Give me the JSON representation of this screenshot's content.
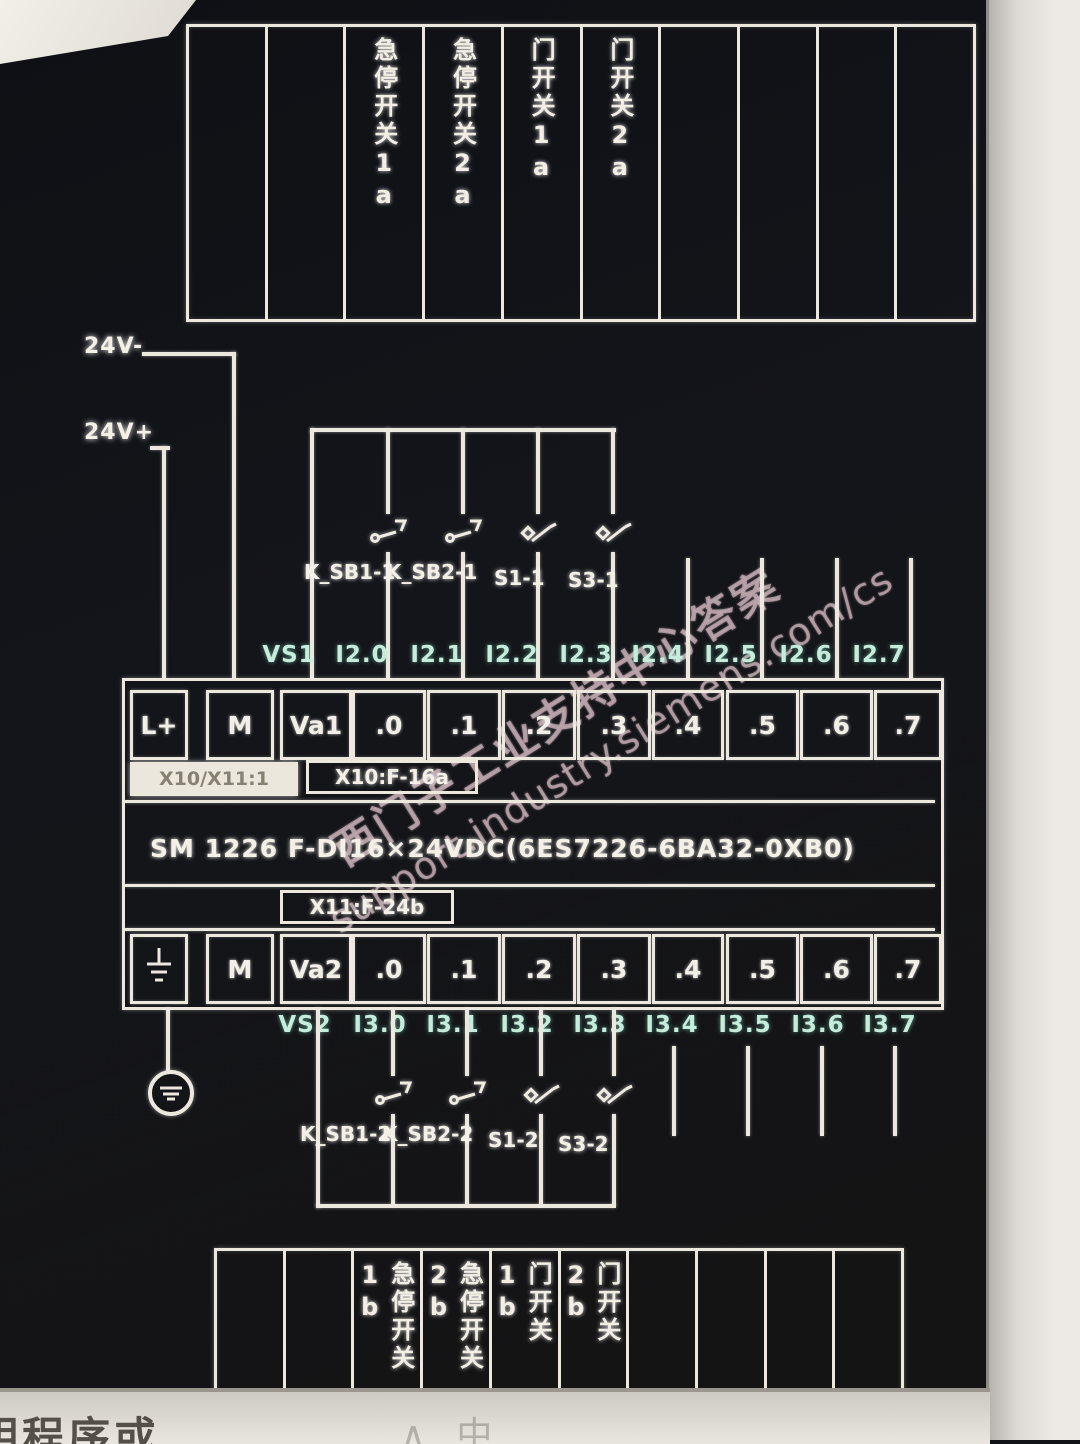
{
  "watermark": {
    "line1": "西门子工业支持中心答案",
    "line2": "support.industry.siemens.com/cs"
  },
  "screen": {
    "bottom_text": "明程序或",
    "bottom_marks": "∧中"
  },
  "power": {
    "neg_label": "24V-",
    "pos_label": "24V+"
  },
  "top_strip": {
    "columns": [
      "",
      "",
      "急停开关1a",
      "急停开关2a",
      "门开关1a",
      "门开关2a",
      "",
      "",
      "",
      ""
    ]
  },
  "bottom_strip": {
    "columns": [
      "",
      "",
      "急停开关1b",
      "急停开关2b",
      "门开关1b",
      "门开关2b",
      "",
      "",
      "",
      ""
    ]
  },
  "io_labels": {
    "top": [
      "VS1",
      "I2.0",
      "I2.1",
      "I2.2",
      "I2.3",
      "I2.4",
      "I2.5",
      "I2.6",
      "I2.7"
    ],
    "bottom": [
      "VS2",
      "I3.0",
      "I3.1",
      "I3.2",
      "I3.3",
      "I3.4",
      "I3.5",
      "I3.6",
      "I3.7"
    ]
  },
  "switches": {
    "top": [
      "K_SB1-1",
      "K_SB2-1",
      "S1-1",
      "S3-1"
    ],
    "bottom": [
      "K_SB1-2",
      "K_SB2-2",
      "S1-2",
      "S3-2"
    ]
  },
  "terminal_block": {
    "row1": [
      "L+",
      "M",
      "Va1",
      ".0",
      ".1",
      ".2",
      ".3",
      ".4",
      ".5",
      ".6",
      ".7"
    ],
    "row2": [
      "",
      "M",
      "Va2",
      ".0",
      ".1",
      ".2",
      ".3",
      ".4",
      ".5",
      ".6",
      ".7"
    ],
    "highlight_label": "X10/X11:1",
    "connector_top": "X10:F-16a",
    "connector_bottom": "X11:F-24b",
    "module": "SM 1226 F-DI16×24VDC(6ES7226-6BA32-0XB0)"
  }
}
